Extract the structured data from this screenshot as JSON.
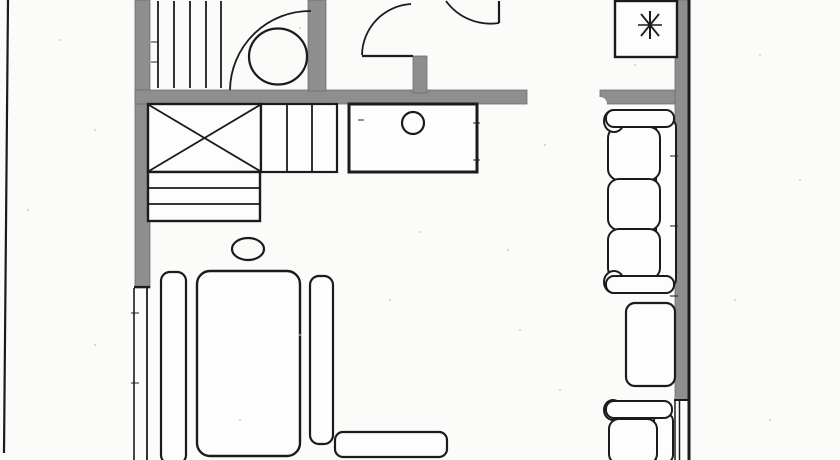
{
  "palette": {
    "bg": "#fbfbfa",
    "line": "#1b1b1b",
    "wall": "#8e8e8e",
    "wallEdge": "#6d6d6d",
    "white": "#fdfdfd",
    "speck": "#c2c2c2"
  },
  "canvas": {
    "w": 840,
    "h": 460
  },
  "shapes": [
    {
      "name": "wall-left",
      "type": "rect",
      "x": 135,
      "y": 0,
      "w": 15,
      "h": 288,
      "fill": "wall",
      "stroke": "wallEdge",
      "sw": 0.8
    },
    {
      "name": "wall-top-main",
      "type": "rect",
      "x": 135,
      "y": 90,
      "w": 392,
      "h": 14,
      "fill": "wall",
      "stroke": "wallEdge",
      "sw": 0.8
    },
    {
      "name": "wall-bathroom-right",
      "type": "rect",
      "x": 308,
      "y": 0,
      "w": 18,
      "h": 91,
      "fill": "wall",
      "stroke": "wallEdge",
      "sw": 0.8
    },
    {
      "name": "wall-entry-stub",
      "type": "rect",
      "x": 413,
      "y": 56,
      "w": 14,
      "h": 37,
      "fill": "wall",
      "stroke": "wallEdge",
      "sw": 0.8
    },
    {
      "name": "wall-top-right",
      "type": "rect",
      "x": 600,
      "y": 90,
      "w": 90,
      "h": 14,
      "fill": "wall",
      "stroke": "wallEdge",
      "sw": 0.8
    },
    {
      "name": "wall-right",
      "type": "rect",
      "x": 675,
      "y": 0,
      "w": 13,
      "h": 400,
      "fill": "wall",
      "stroke": "wallEdge",
      "sw": 0.8
    },
    {
      "name": "wall-break-notch",
      "type": "ellipse",
      "cx": 600,
      "cy": 104,
      "rx": 7,
      "ry": 7,
      "fill": "bg"
    },
    {
      "name": "page-edge-line-left",
      "type": "line",
      "x1": 8,
      "y1": 0,
      "x2": 4,
      "y2": 453,
      "stroke": "line",
      "sw": 2.2
    },
    {
      "name": "outer-wall-line-right",
      "type": "line",
      "x1": 689,
      "y1": 0,
      "x2": 689,
      "y2": 460,
      "stroke": "line",
      "sw": 3
    },
    {
      "name": "wall-left-end-cap",
      "type": "line",
      "x1": 134,
      "y1": 287,
      "x2": 150,
      "y2": 287,
      "stroke": "line",
      "sw": 2.2
    },
    {
      "name": "wall-right-end-cap",
      "type": "line",
      "x1": 674,
      "y1": 400,
      "x2": 688,
      "y2": 400,
      "stroke": "line",
      "sw": 2
    },
    {
      "name": "window-left-line-1",
      "type": "line",
      "x1": 134,
      "y1": 288,
      "x2": 134,
      "y2": 460,
      "stroke": "line",
      "sw": 1.6
    },
    {
      "name": "window-left-line-2",
      "type": "line",
      "x1": 147,
      "y1": 288,
      "x2": 147,
      "y2": 460,
      "stroke": "line",
      "sw": 1.8
    },
    {
      "name": "window-right-line-1",
      "type": "line",
      "x1": 675,
      "y1": 400,
      "x2": 675,
      "y2": 460,
      "stroke": "line",
      "sw": 1.5
    },
    {
      "name": "window-right-line-2",
      "type": "line",
      "x1": 679.5,
      "y1": 400,
      "x2": 679.5,
      "y2": 460,
      "stroke": "line",
      "sw": 1.5
    },
    {
      "name": "closet-hatch-line-1",
      "type": "line",
      "x1": 158,
      "y1": 1,
      "x2": 158,
      "y2": 88,
      "stroke": "line",
      "sw": 1.8
    },
    {
      "name": "closet-hatch-line-2",
      "type": "line",
      "x1": 174,
      "y1": 1,
      "x2": 174,
      "y2": 88,
      "stroke": "line",
      "sw": 1.8
    },
    {
      "name": "closet-hatch-line-3",
      "type": "line",
      "x1": 190,
      "y1": 1,
      "x2": 190,
      "y2": 88,
      "stroke": "line",
      "sw": 1.8
    },
    {
      "name": "closet-hatch-line-4",
      "type": "line",
      "x1": 206,
      "y1": 1,
      "x2": 206,
      "y2": 88,
      "stroke": "line",
      "sw": 1.8
    },
    {
      "name": "closet-hatch-line-5",
      "type": "line",
      "x1": 221,
      "y1": 1,
      "x2": 221,
      "y2": 88,
      "stroke": "line",
      "sw": 1.8
    },
    {
      "name": "bathroom-fixture-circle",
      "type": "ellipse",
      "cx": 278,
      "cy": 56.5,
      "rx": 29,
      "ry": 28,
      "stroke": "line",
      "sw": 2.2
    },
    {
      "name": "bathroom-door-arc",
      "type": "path",
      "d": "M 230 90 A 80 80 0 0 1 311 11",
      "stroke": "line",
      "sw": 1.8
    },
    {
      "name": "entry-door-leaf",
      "type": "line",
      "x1": 362,
      "y1": 56,
      "x2": 413,
      "y2": 56,
      "stroke": "line",
      "sw": 2.2
    },
    {
      "name": "entry-door-arc",
      "type": "path",
      "d": "M 362 55 A 52 52 0 0 1 411 4",
      "stroke": "line",
      "sw": 1.8
    },
    {
      "name": "hall-door-leaf",
      "type": "line",
      "x1": 499,
      "y1": 1,
      "x2": 499,
      "y2": 23,
      "stroke": "line",
      "sw": 2.2
    },
    {
      "name": "hall-door-arc",
      "type": "path",
      "d": "M 446 1 A 55 55 0 0 0 499 23",
      "stroke": "line",
      "sw": 1.8
    },
    {
      "name": "utility-box",
      "type": "rect",
      "x": 615,
      "y": 1,
      "w": 62,
      "h": 56,
      "fill": "white",
      "stroke": "line",
      "sw": 2.4
    },
    {
      "name": "utility-asterisk-vertical",
      "type": "line",
      "x1": 650,
      "y1": 11,
      "x2": 650,
      "y2": 39,
      "stroke": "line",
      "sw": 2
    },
    {
      "name": "utility-asterisk-horizontal",
      "type": "line",
      "x1": 638,
      "y1": 25,
      "x2": 662,
      "y2": 25,
      "stroke": "line",
      "sw": 1.5
    },
    {
      "name": "utility-asterisk-diag-1",
      "type": "line",
      "x1": 641,
      "y1": 14,
      "x2": 659,
      "y2": 36,
      "stroke": "line",
      "sw": 1.8
    },
    {
      "name": "utility-asterisk-diag-2",
      "type": "line",
      "x1": 659,
      "y1": 14,
      "x2": 641,
      "y2": 36,
      "stroke": "line",
      "sw": 1.8
    },
    {
      "name": "kitchen-counter",
      "type": "rect",
      "x": 349,
      "y": 104,
      "w": 128,
      "h": 68,
      "fill": "white",
      "stroke": "line",
      "sw": 3
    },
    {
      "name": "kitchen-sink-circle",
      "type": "ellipse",
      "cx": 413,
      "cy": 123,
      "rx": 11,
      "ry": 11,
      "stroke": "line",
      "sw": 2.2
    },
    {
      "name": "wardrobe-box",
      "type": "rect",
      "x": 148,
      "y": 104,
      "w": 113,
      "h": 68,
      "fill": "white",
      "stroke": "line",
      "sw": 2.4
    },
    {
      "name": "wardrobe-x-diag-1",
      "type": "line",
      "x1": 149,
      "y1": 105,
      "x2": 260,
      "y2": 171,
      "stroke": "line",
      "sw": 1.8
    },
    {
      "name": "wardrobe-x-diag-2",
      "type": "line",
      "x1": 149,
      "y1": 171,
      "x2": 260,
      "y2": 105,
      "stroke": "line",
      "sw": 1.8
    },
    {
      "name": "cabinet-box",
      "type": "rect",
      "x": 261,
      "y": 104,
      "w": 76,
      "h": 68,
      "fill": "white",
      "stroke": "line",
      "sw": 2.2
    },
    {
      "name": "cabinet-divider-1",
      "type": "line",
      "x1": 287,
      "y1": 104,
      "x2": 287,
      "y2": 172,
      "stroke": "line",
      "sw": 1.8
    },
    {
      "name": "cabinet-divider-2",
      "type": "line",
      "x1": 312,
      "y1": 104,
      "x2": 312,
      "y2": 172,
      "stroke": "line",
      "sw": 1.8
    },
    {
      "name": "shelf-box",
      "type": "rect",
      "x": 148,
      "y": 172,
      "w": 112,
      "h": 49,
      "fill": "white",
      "stroke": "line",
      "sw": 2.4
    },
    {
      "name": "shelf-divider-1",
      "type": "line",
      "x1": 148,
      "y1": 188,
      "x2": 260,
      "y2": 188,
      "stroke": "line",
      "sw": 1.8
    },
    {
      "name": "shelf-divider-2",
      "type": "line",
      "x1": 148,
      "y1": 204,
      "x2": 260,
      "y2": 204,
      "stroke": "line",
      "sw": 1.8
    },
    {
      "name": "stool-ellipse",
      "type": "ellipse",
      "cx": 248,
      "cy": 249,
      "rx": 16,
      "ry": 11,
      "stroke": "line",
      "sw": 2.2
    },
    {
      "name": "bed-side-rail-left",
      "type": "rect",
      "x": 161,
      "y": 272,
      "w": 25,
      "h": 192,
      "rx": 9,
      "fill": "white",
      "stroke": "line",
      "sw": 2.2
    },
    {
      "name": "bed",
      "type": "rect",
      "x": 197,
      "y": 271,
      "w": 103,
      "h": 185,
      "rx": 13,
      "fill": "white",
      "stroke": "line",
      "sw": 2.4
    },
    {
      "name": "bed-side-rail-right",
      "type": "rect",
      "x": 310,
      "y": 276,
      "w": 23,
      "h": 168,
      "rx": 9,
      "fill": "white",
      "stroke": "line",
      "sw": 2.2
    },
    {
      "name": "foot-bench",
      "type": "rect",
      "x": 335,
      "y": 432,
      "w": 112,
      "h": 25,
      "rx": 8,
      "fill": "white",
      "stroke": "line",
      "sw": 2.2
    },
    {
      "name": "sofa-backrest",
      "type": "rect",
      "x": 656,
      "y": 118,
      "w": 20,
      "h": 170,
      "rx": 9,
      "fill": "white",
      "stroke": "line",
      "sw": 2
    },
    {
      "name": "sofa-cushion-1",
      "type": "rect",
      "x": 608,
      "y": 127,
      "w": 52,
      "h": 53,
      "rx": 11,
      "fill": "white",
      "stroke": "line",
      "sw": 2
    },
    {
      "name": "sofa-cushion-2",
      "type": "rect",
      "x": 608,
      "y": 179,
      "w": 52,
      "h": 51,
      "rx": 11,
      "fill": "white",
      "stroke": "line",
      "sw": 2
    },
    {
      "name": "sofa-cushion-3",
      "type": "rect",
      "x": 608,
      "y": 229,
      "w": 52,
      "h": 50,
      "rx": 11,
      "fill": "white",
      "stroke": "line",
      "sw": 2
    },
    {
      "name": "sofa-arm-top-knob",
      "type": "ellipse",
      "cx": 614,
      "cy": 121,
      "rx": 10,
      "ry": 11,
      "fill": "white",
      "stroke": "line",
      "sw": 2
    },
    {
      "name": "sofa-arm-top",
      "type": "rect",
      "x": 606,
      "y": 110,
      "w": 68,
      "h": 17,
      "rx": 8,
      "fill": "white",
      "stroke": "line",
      "sw": 2
    },
    {
      "name": "sofa-arm-bottom-knob",
      "type": "ellipse",
      "cx": 614,
      "cy": 282,
      "rx": 10,
      "ry": 11,
      "fill": "white",
      "stroke": "line",
      "sw": 2
    },
    {
      "name": "sofa-arm-bottom",
      "type": "rect",
      "x": 606,
      "y": 276,
      "w": 68,
      "h": 17,
      "rx": 8,
      "fill": "white",
      "stroke": "line",
      "sw": 2
    },
    {
      "name": "side-table",
      "type": "rect",
      "x": 626,
      "y": 303,
      "w": 49,
      "h": 83,
      "rx": 9,
      "fill": "white",
      "stroke": "line",
      "sw": 2.2
    },
    {
      "name": "armchair-back",
      "type": "rect",
      "x": 654,
      "y": 413,
      "w": 19,
      "h": 50,
      "rx": 8,
      "fill": "white",
      "stroke": "line",
      "sw": 2
    },
    {
      "name": "armchair-seat",
      "type": "rect",
      "x": 609,
      "y": 419,
      "w": 48,
      "h": 45,
      "rx": 10,
      "fill": "white",
      "stroke": "line",
      "sw": 2
    },
    {
      "name": "armchair-arm-knob",
      "type": "ellipse",
      "cx": 613,
      "cy": 410,
      "rx": 9,
      "ry": 10,
      "fill": "white",
      "stroke": "line",
      "sw": 2
    },
    {
      "name": "armchair-arm",
      "type": "rect",
      "x": 606,
      "y": 401,
      "w": 66,
      "h": 17,
      "rx": 8,
      "fill": "white",
      "stroke": "line",
      "sw": 2
    },
    {
      "name": "scan-tick",
      "type": "line",
      "x1": 670,
      "y1": 156,
      "x2": 678,
      "y2": 156,
      "stroke": "line",
      "sw": 1.2,
      "op": 0.85
    },
    {
      "name": "scan-tick",
      "type": "line",
      "x1": 670,
      "y1": 226,
      "x2": 678,
      "y2": 226,
      "stroke": "line",
      "sw": 1.2,
      "op": 0.85
    },
    {
      "name": "scan-tick",
      "type": "line",
      "x1": 670,
      "y1": 296,
      "x2": 678,
      "y2": 296,
      "stroke": "line",
      "sw": 1.2,
      "op": 0.85
    },
    {
      "name": "scan-tick",
      "type": "line",
      "x1": 131,
      "y1": 313,
      "x2": 139,
      "y2": 313,
      "stroke": "line",
      "sw": 1.2,
      "op": 0.8
    },
    {
      "name": "scan-tick",
      "type": "line",
      "x1": 131,
      "y1": 383,
      "x2": 139,
      "y2": 383,
      "stroke": "line",
      "sw": 1.2,
      "op": 0.8
    },
    {
      "name": "scan-tick",
      "type": "line",
      "x1": 151,
      "y1": 42,
      "x2": 158,
      "y2": 42,
      "stroke": "line",
      "sw": 1.2,
      "op": 0.8
    },
    {
      "name": "scan-tick",
      "type": "line",
      "x1": 151,
      "y1": 62,
      "x2": 158,
      "y2": 62,
      "stroke": "line",
      "sw": 1.2,
      "op": 0.8
    },
    {
      "name": "scan-tick",
      "type": "line",
      "x1": 473,
      "y1": 123,
      "x2": 480,
      "y2": 123,
      "stroke": "line",
      "sw": 1.2,
      "op": 0.8
    },
    {
      "name": "scan-tick",
      "type": "line",
      "x1": 473,
      "y1": 160,
      "x2": 480,
      "y2": 160,
      "stroke": "line",
      "sw": 1.2,
      "op": 0.8
    },
    {
      "name": "scan-tick",
      "type": "line",
      "x1": 358,
      "y1": 120,
      "x2": 364,
      "y2": 120,
      "stroke": "line",
      "sw": 1.2,
      "op": 0.8
    }
  ],
  "speckles": [
    [
      60,
      40
    ],
    [
      300,
      28
    ],
    [
      95,
      130
    ],
    [
      28,
      210
    ],
    [
      545,
      145
    ],
    [
      760,
      55
    ],
    [
      800,
      180
    ],
    [
      735,
      300
    ],
    [
      508,
      250
    ],
    [
      420,
      232
    ],
    [
      300,
      335
    ],
    [
      95,
      345
    ],
    [
      240,
      420
    ],
    [
      770,
      420
    ],
    [
      520,
      330
    ],
    [
      635,
      65
    ],
    [
      390,
      300
    ],
    [
      560,
      390
    ]
  ]
}
